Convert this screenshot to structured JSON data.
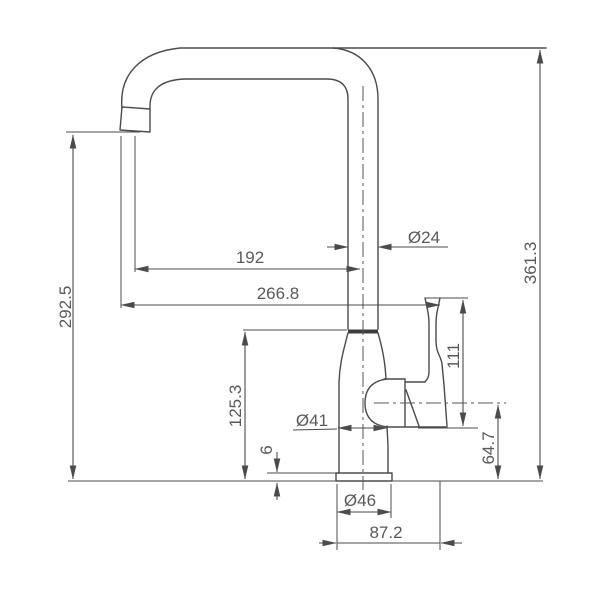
{
  "drawing": {
    "title": "Kitchen faucet technical dimension drawing",
    "view": "side elevation",
    "units": "mm",
    "background_color": "#ffffff",
    "line_color": "#4b4b4b",
    "text_color": "#595959"
  },
  "dims": {
    "spout_outlet_height": "292.5",
    "spout_reach_to_center": "192",
    "overall_reach": "266.8",
    "spout_tube_diameter": "Ø24",
    "overall_height": "361.3",
    "handle_height": "111",
    "body_height": "125.3",
    "body_diameter": "Ø41",
    "pivot_height": "64.7",
    "base_plate_thickness": "6",
    "base_diameter": "Ø46",
    "base_to_handle_reach": "87.2"
  }
}
